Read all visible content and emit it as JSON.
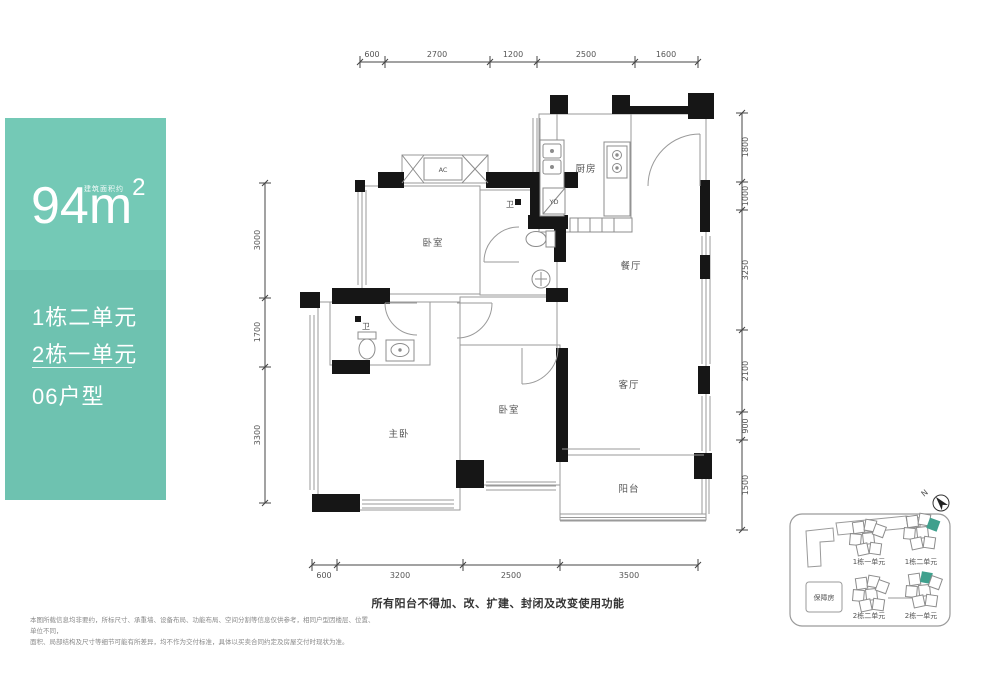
{
  "panel": {
    "area_note": "建筑面积约",
    "area_value": "94",
    "area_unit": "m",
    "area_sup": "2",
    "unit_line1": "1栋二单元",
    "unit_line2": "2栋一单元",
    "type_label": "06户型"
  },
  "rooms": {
    "bedroom1": "卧室",
    "bath_upper": "卫",
    "kitchen": "厨房",
    "yd": "YD",
    "ac": "AC",
    "dining": "餐厅",
    "living": "客厅",
    "bedroom2": "卧室",
    "master": "主卧",
    "bath_lower": "卫",
    "balcony": "阳台"
  },
  "dims": {
    "top": [
      "600",
      "2700",
      "1200",
      "2500",
      "1600"
    ],
    "bottom": [
      "600",
      "3200",
      "2500",
      "3500"
    ],
    "left": [
      "3000",
      "1700",
      "3300"
    ],
    "right": [
      "1800",
      "1000",
      "3250",
      "2100",
      "900",
      "1500"
    ]
  },
  "sitemap": {
    "north": "N",
    "block1_unit1": "1栋一单元",
    "block1_unit2": "1栋二单元",
    "block2_unit2": "2栋二单元",
    "block2_unit1": "2栋一单元",
    "support_housing": "保障房"
  },
  "notes": {
    "balcony_notice": "所有阳台不得加、改、扩建、封闭及改变使用功能",
    "disclaimer_line1": "本图所载信息均非要约，所标尺寸、承重墙、设备布局、功能布局、空间分割等信息仅供参考，相同户型因楼层、位置、单位不同，",
    "disclaimer_line2": "面积、局部结构及尺寸等细节可能有所差异，均不作为交付标准，具体以买卖合同约定及房屋交付时现状为准。"
  },
  "colors": {
    "accent_panel": "#70C5B2",
    "accent_unit": "#3FA08D",
    "wall": "#161616"
  }
}
